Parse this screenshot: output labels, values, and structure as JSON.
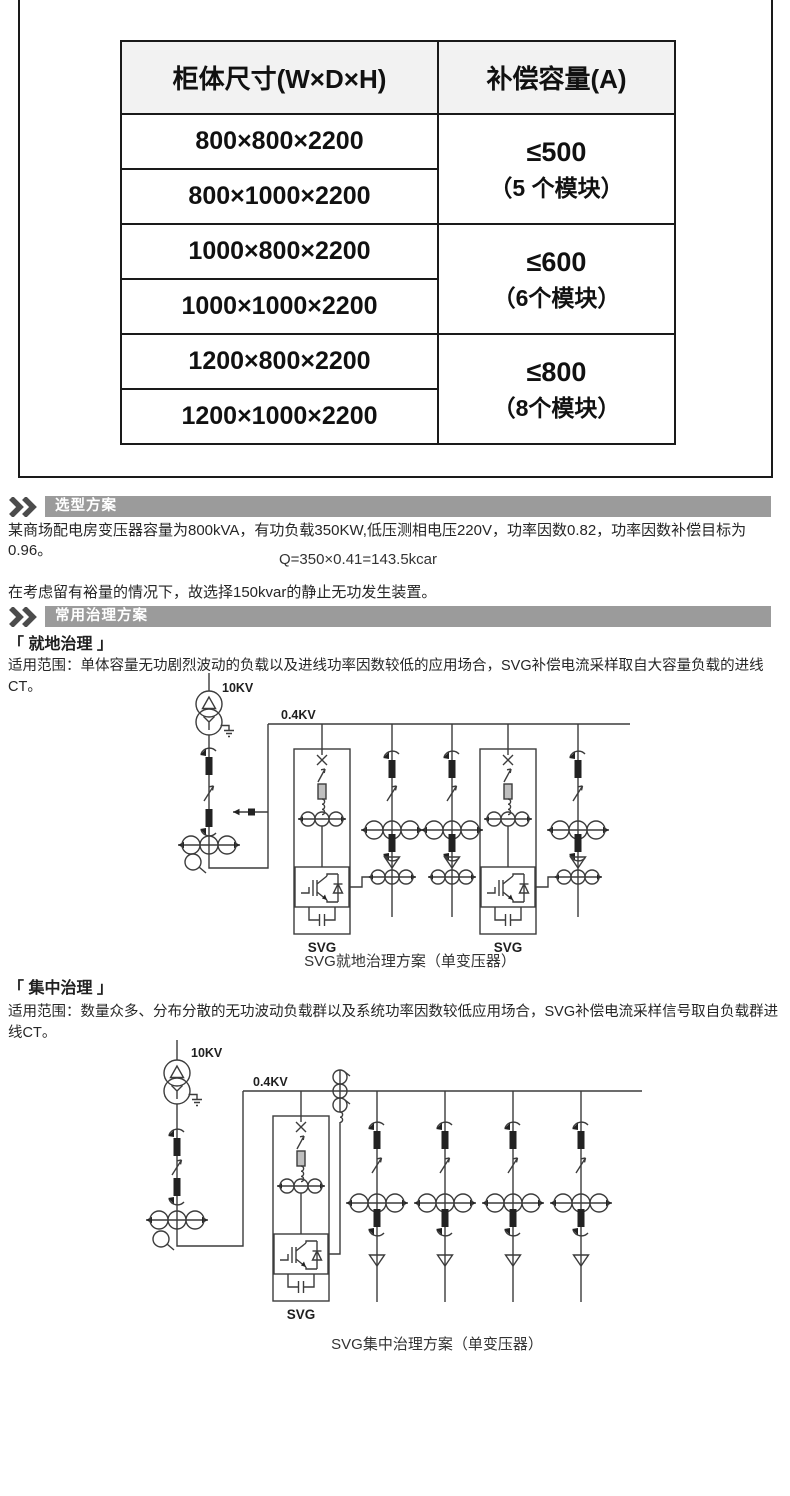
{
  "table": {
    "col1_header": "柜体尺寸(W×D×H)",
    "col2_header": "补偿容量(A)",
    "rows": [
      "800×800×2200",
      "800×1000×2200",
      "1000×800×2200",
      "1000×1000×2200",
      "1200×800×2200",
      "1200×1000×2200"
    ],
    "capacities": [
      {
        "limit": "≤500",
        "modules": "（5 个模块）"
      },
      {
        "limit": "≤600",
        "modules": "（6个模块）"
      },
      {
        "limit": "≤800",
        "modules": "（8个模块）"
      }
    ]
  },
  "sections": {
    "selection_title": "选型方案",
    "treatment_title": "常用治理方案"
  },
  "selection": {
    "paragraph": "某商场配电房变压器容量为800kVA，有功负载350KW,低压测相电压220V，功率因数0.82，功率因数补偿目标为0.96。",
    "formula": "Q=350×0.41=143.5kcar",
    "conclusion": "在考虑留有裕量的情况下，故选择150kvar的静止无功发生装置。"
  },
  "local_treatment": {
    "heading": "「 就地治理 」",
    "scope": "适用范围：单体容量无功剧烈波动的负载以及进线功率因数较低的应用场合，SVG补偿电流采样取自大容量负载的进线CT。",
    "hv_label": "10KV",
    "lv_label": "0.4KV",
    "svg_label": "SVG",
    "caption": "SVG就地治理方案（单变压器）"
  },
  "central_treatment": {
    "heading": "「 集中治理 」",
    "scope": "适用范围：数量众多、分布分散的无功波动负载群以及系统功率因数较低应用场合，SVG补偿电流采样信号取自负载群进线CT。",
    "hv_label": "10KV",
    "lv_label": "0.4KV",
    "svg_label": "SVG",
    "caption": "SVG集中治理方案（单变压器）"
  },
  "colors": {
    "section_bar_bg": "#9b9b9b",
    "table_header_bg": "#f2f2f2",
    "diagram_stroke": "#3c3c3c"
  }
}
